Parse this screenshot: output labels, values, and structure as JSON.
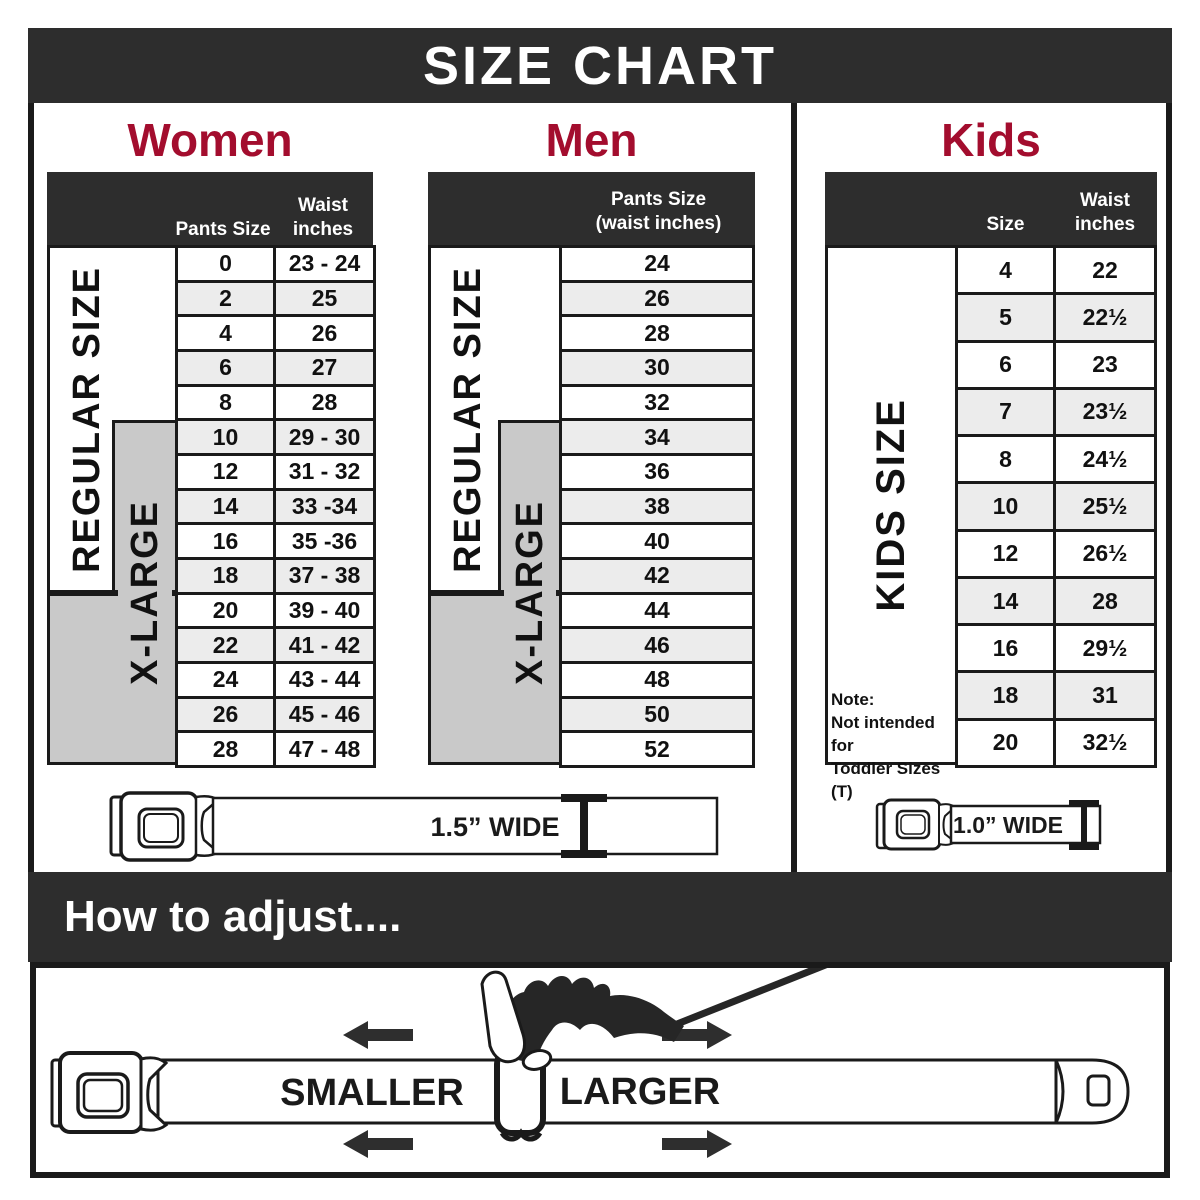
{
  "title": "SIZE CHART",
  "colors": {
    "bar_dark": "#2d2d2d",
    "accent_red": "#a30d2e",
    "gray_box": "#c9c9c9",
    "row_alt": "#ececec",
    "line_black": "#1a1a1a"
  },
  "women": {
    "heading": "Women",
    "col_header_pants": "Pants Size",
    "col_header_waist_line1": "Waist",
    "col_header_waist_line2": "inches",
    "regular_label": "REGULAR SIZE",
    "xlarge_label": "X-LARGE",
    "rows": [
      {
        "size": "0",
        "waist": "23 - 24"
      },
      {
        "size": "2",
        "waist": "25"
      },
      {
        "size": "4",
        "waist": "26"
      },
      {
        "size": "6",
        "waist": "27"
      },
      {
        "size": "8",
        "waist": "28"
      },
      {
        "size": "10",
        "waist": "29 - 30"
      },
      {
        "size": "12",
        "waist": "31 - 32"
      },
      {
        "size": "14",
        "waist": "33 -34"
      },
      {
        "size": "16",
        "waist": "35 -36"
      },
      {
        "size": "18",
        "waist": "37 - 38"
      },
      {
        "size": "20",
        "waist": "39 - 40"
      },
      {
        "size": "22",
        "waist": "41 - 42"
      },
      {
        "size": "24",
        "waist": "43 - 44"
      },
      {
        "size": "26",
        "waist": "45 - 46"
      },
      {
        "size": "28",
        "waist": "47 - 48"
      }
    ]
  },
  "men": {
    "heading": "Men",
    "col_header_line1": "Pants Size",
    "col_header_line2": "(waist inches)",
    "regular_label": "REGULAR SIZE",
    "xlarge_label": "X-LARGE",
    "rows": [
      "24",
      "26",
      "28",
      "30",
      "32",
      "34",
      "36",
      "38",
      "40",
      "42",
      "44",
      "46",
      "48",
      "50",
      "52"
    ]
  },
  "kids": {
    "heading": "Kids",
    "col_header_size": "Size",
    "col_header_waist_line1": "Waist",
    "col_header_waist_line2": "inches",
    "side_label": "KIDS SIZE",
    "note_line1": "Note:",
    "note_line2": "Not intended for",
    "note_line3": "Toddler Sizes (T)",
    "rows": [
      {
        "size": "4",
        "waist": "22"
      },
      {
        "size": "5",
        "waist": "22½"
      },
      {
        "size": "6",
        "waist": "23"
      },
      {
        "size": "7",
        "waist": "23½"
      },
      {
        "size": "8",
        "waist": "24½"
      },
      {
        "size": "10",
        "waist": "25½"
      },
      {
        "size": "12",
        "waist": "26½"
      },
      {
        "size": "14",
        "waist": "28"
      },
      {
        "size": "16",
        "waist": "29½"
      },
      {
        "size": "18",
        "waist": "31"
      },
      {
        "size": "20",
        "waist": "32½"
      }
    ]
  },
  "belts": {
    "adult_width_label": "1.5” WIDE",
    "kids_width_label": "1.0” WIDE"
  },
  "adjust": {
    "heading": "How to adjust....",
    "smaller_label": "SMALLER",
    "larger_label": "LARGER"
  }
}
